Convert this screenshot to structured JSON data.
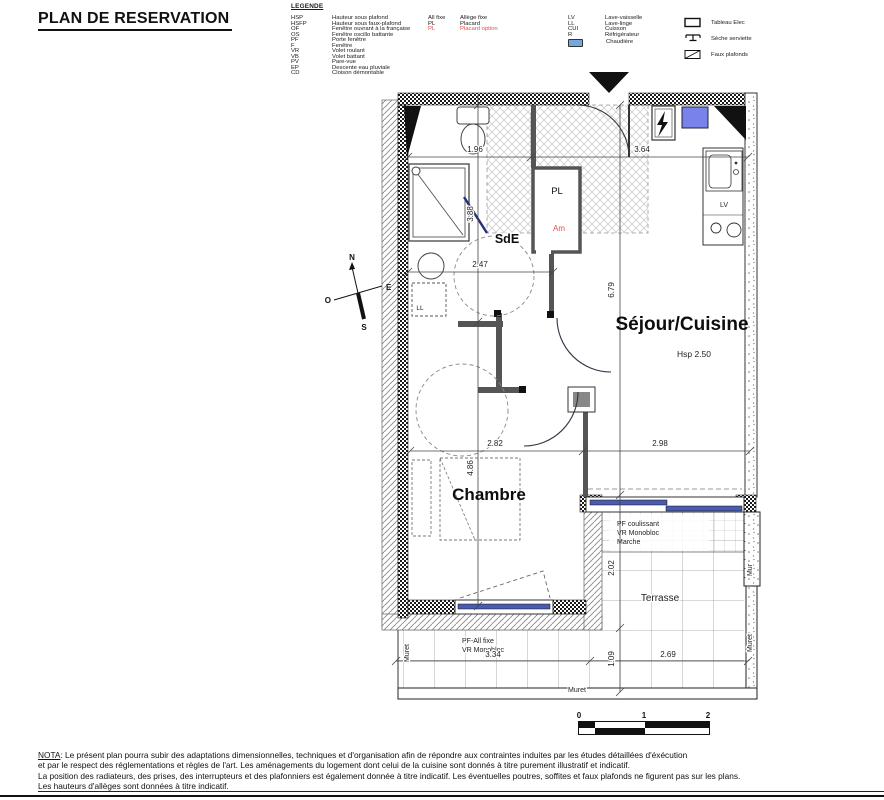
{
  "title": "PLAN DE RESERVATION",
  "legend": {
    "heading": "LEGENDE",
    "col1": [
      {
        "key": "HSP",
        "label": "Hauteur sous plafond"
      },
      {
        "key": "HSFP",
        "label": "Hauteur sous faux-plafond"
      },
      {
        "key": "OF",
        "label": "Fenêtre ouvrant à la française"
      },
      {
        "key": "OS",
        "label": "Fenêtre oscillo battante"
      },
      {
        "key": "PF",
        "label": "Porte fenêtre"
      },
      {
        "key": "F",
        "label": "Fenêtre"
      },
      {
        "key": "VR",
        "label": "Volet roulant"
      },
      {
        "key": "VB",
        "label": "Volet battant"
      },
      {
        "key": "PV",
        "label": "Pare-vue"
      },
      {
        "key": "EP",
        "label": "Descente eau pluviale"
      },
      {
        "key": "CD",
        "label": "Cloison démontable"
      }
    ],
    "col2": [
      {
        "key": "All fixe",
        "label": "Allège fixe"
      },
      {
        "key": "PL",
        "label": "Placard"
      },
      {
        "key": "PL",
        "label": "Placard option"
      }
    ],
    "col3": [
      {
        "key": "LV",
        "label": "Lave-vaisselle"
      },
      {
        "key": "LL",
        "label": "Lave-linge"
      },
      {
        "key": "CUI",
        "label": "Cuisson"
      },
      {
        "key": "R",
        "label": "Réfrigérateur"
      }
    ],
    "chaudiere_label": "Chaudière",
    "col4": [
      {
        "label": "Tableau Elec"
      },
      {
        "label": "Sèche serviette"
      },
      {
        "label": "Faux plafonds"
      }
    ]
  },
  "plan": {
    "rooms": {
      "sde": "SdE",
      "sejour": "Séjour/Cuisine",
      "sejour_hsp": "Hsp 2.50",
      "chambre": "Chambre",
      "terrasse": "Terrasse"
    },
    "labels": {
      "pl": "PL",
      "am": "Am",
      "lv": "LV",
      "ll": "LL",
      "mur": "Mur",
      "muret": "Muret",
      "pf_coulissant": "PF coulissant",
      "vr_monobloc": "VR Monobloc",
      "marche": "Marche",
      "pf_all_fixe": "PF-All fixe"
    },
    "compass": {
      "n": "N",
      "s": "S",
      "e": "E",
      "o": "O"
    },
    "dims": {
      "w_196": "1.96",
      "w_364": "3.64",
      "w_247": "2.47",
      "h_388": "3.88",
      "h_679": "6.79",
      "w_282": "2.82",
      "w_298": "2.98",
      "h_486": "4.86",
      "h_202": "2.02",
      "h_109": "1.09",
      "w_269": "2.69",
      "w_334": "3.34"
    }
  },
  "scalebar": {
    "t0": "0",
    "t1": "1",
    "t2": "2"
  },
  "nota": {
    "label": "NOTA",
    "line1": ": Le présent plan pourra subir des adaptations dimensionnelles, techniques et d'organisation afin de répondre aux contraintes induites par les études détaillées d'éxécution",
    "line2": "et par le respect des réglementations et règles de l'art. Les aménagements du logement dont celui de la cuisine sont donnés à titre purement illustratif et indicatif.",
    "line3": "La position des radiateurs, des prises, des interrupteurs et des plafonniers est également donnée à titre indicatif. Les éventuelles poutres, soffites et faux plafonds ne figurent pas sur les plans.",
    "line4": "Les hauteurs d'allèges sont données à titre indicatif."
  },
  "colors": {
    "option_red": "#ef4b4e",
    "glazing_blue": "#4a5cae",
    "boiler_blue": "#7982ea",
    "legend_boiler_blue": "#72a7e0"
  }
}
